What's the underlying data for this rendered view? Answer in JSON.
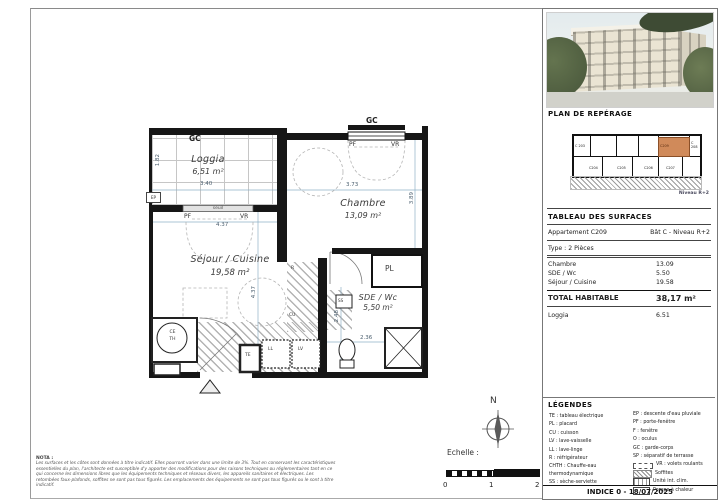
{
  "plan": {
    "loggia": {
      "gc": "GC",
      "name": "Loggia",
      "area": "6,51 m²",
      "dim_w": "3.40",
      "dim_h": "1.82",
      "ep": "EP",
      "seuil": "seuil",
      "pf": "PF",
      "vr": "VR",
      "door_dim": "4.37"
    },
    "chambre": {
      "gc": "GC",
      "pf": "PF",
      "vr": "VR",
      "name": "Chambre",
      "area": "13,09 m²",
      "dim_w": "3.73",
      "dim_h": "3.89"
    },
    "sejour": {
      "name": "Séjour / Cuisine",
      "area": "19,58 m²",
      "dim_h": "4.37",
      "ce": "CE",
      "th": "TH",
      "te": "TE",
      "ll": "LL",
      "lv": "LV",
      "r": "R",
      "cu": "CU"
    },
    "sde": {
      "name": "SDE / Wc",
      "area": "5,50 m²",
      "dim_w": "2.36",
      "dim_h": "2.48",
      "ss": "SS"
    },
    "pl_label": "PL"
  },
  "sidebar": {
    "reperage_title": "PLAN DE REPÉRAGE",
    "niveau": "Niveau R+2",
    "mini": {
      "c203": "C 203",
      "c204": "C204",
      "c205": "C205",
      "c206": "C206",
      "c207": "C207",
      "c208": "C 208",
      "highlight": "C209"
    },
    "table": {
      "title": "TABLEAU DES SURFACES",
      "apartment": "Appartement C209",
      "building": "Bât C - Niveau R+2",
      "type": "Type : 2 Pièces",
      "rows": [
        {
          "label": "Chambre",
          "value": "13.09"
        },
        {
          "label": "SDE / Wc",
          "value": "5.50"
        },
        {
          "label": "Séjour / Cuisine",
          "value": "19.58"
        }
      ],
      "total_label": "TOTAL HABITABLE",
      "total_value": "38,17 m²",
      "loggia_label": "Loggia",
      "loggia_value": "6.51"
    },
    "legend": {
      "title": "LÉGENDES",
      "left": [
        "TE : tableau électrique",
        "PL : placard",
        "CU : cuisson",
        "LV : lave-vaisselle",
        "LL : lave-linge",
        "R : réfrigérateur",
        "CHTH : Chauffe-eau thermodynamique",
        "SS : sèche-serviette"
      ],
      "right": [
        "EP : descente d'eau pluviale",
        "PF : porte-fenêtre",
        "F : fenêtre",
        "O : oculus",
        "GC : garde-corps",
        "SP : séparatif de terrasse"
      ],
      "vr": "VR : volets roulants",
      "soffites": "Soffites",
      "unite": "Unité int. clim.",
      "pompe": "Pompe à chaleur"
    },
    "footer": "INDICE 0 - 18/07/2025"
  },
  "bottom": {
    "north_label": "N",
    "scale_label": "Echelle :",
    "scale_ticks": [
      "0",
      "1",
      "2"
    ],
    "nota_title": "NOTA :",
    "nota_text": "Les surfaces et les côtes sont données à titre indicatif. Elles pourront varier dans une limite de 3%. Tout en conservant les caractéristiques essentielles du plan, l'architecte est susceptible d'y apporter des modifications pour des raisons techniques ou réglementaires tant en ce qui concerne les dimensions libres que les équipements techniques et réseaux divers, les appareils sanitaires et électriques. Les retombées faux-plafonds, soffites ne sont pas tous figurés. Les emplacements des équipements ne sont pas tous figurés ou le sont à titre indicatif."
  }
}
